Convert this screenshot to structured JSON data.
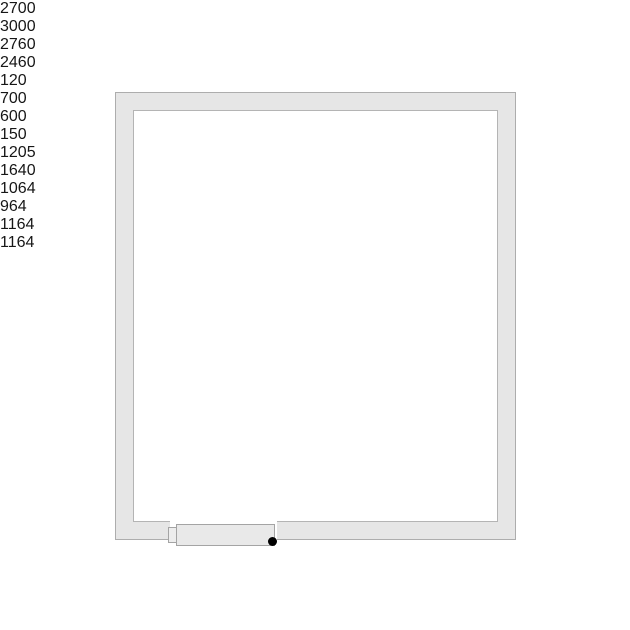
{
  "diagram": {
    "type": "cold-room floor plan, top view",
    "dimensions": {
      "outer_width": "2700",
      "outer_height": "3000",
      "inner_width": "2460",
      "inner_height": "2760",
      "wall_thickness": "120",
      "door_opening": "700",
      "monoblock_width": "600",
      "monoblock_protrusion": "150"
    },
    "shelves": {
      "top": {
        "sections": [
          "1205",
          "1640"
        ]
      },
      "left": {
        "sections": [
          "1064",
          "964"
        ]
      },
      "right": {
        "sections": [
          "1164",
          "1164"
        ]
      }
    },
    "colors": {
      "dimension_arrow_green": "#1e7b1e",
      "dimension_line": "#cdd3cd",
      "wall_fill": "#e6e6e6",
      "shelf_fill": "#f5f5f5",
      "shelf_cap": "#c6c6c6",
      "monoblock_red": "#c23a28",
      "hinge_dot": "#000000"
    }
  }
}
